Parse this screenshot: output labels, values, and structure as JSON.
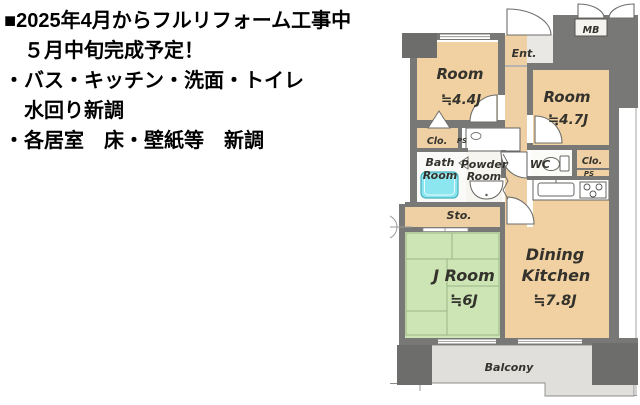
{
  "notice": {
    "lines": [
      "■2025年4月からフルリフォーム工事中",
      "５月中旬完成予定！",
      "・バス・キッチン・洗面・トイレ",
      "水回り新調",
      "・各居室　床・壁紙等　新調"
    ]
  },
  "floorplan": {
    "labels": {
      "room_a_name": "Room",
      "room_a_size": "≒4.4J",
      "room_b_name": "Room",
      "room_b_size": "≒4.7J",
      "j_room_name": "J Room",
      "j_room_size": "≒6J",
      "dk_line1": "Dining",
      "dk_line2": "Kitchen",
      "dk_size": "≒7.8J",
      "bath_line1": "Bath",
      "bath_line2": "Room",
      "powder_line1": "Powder",
      "powder_line2": "Room",
      "wc": "WC",
      "closet_left": "Clo.",
      "closet_right": "Clo.",
      "ps_left": "PS",
      "ps_right": "PS",
      "storage": "Sto.",
      "entrance": "Ent.",
      "meter_box": "MB",
      "balcony": "Balcony",
      "compass_north": "N"
    },
    "colors": {
      "wall": "#787876",
      "column": "#6d6d6b",
      "room_floor": "#f1d1a1",
      "tatami_floor": "#cde4b5",
      "tatami_line": "#9ab586",
      "entry_floor": "#e9e8e4",
      "balcony_floor": "#e0dfdb",
      "bath_floor": "#fafaf8",
      "bathtub": "#8ce6f0"
    }
  }
}
